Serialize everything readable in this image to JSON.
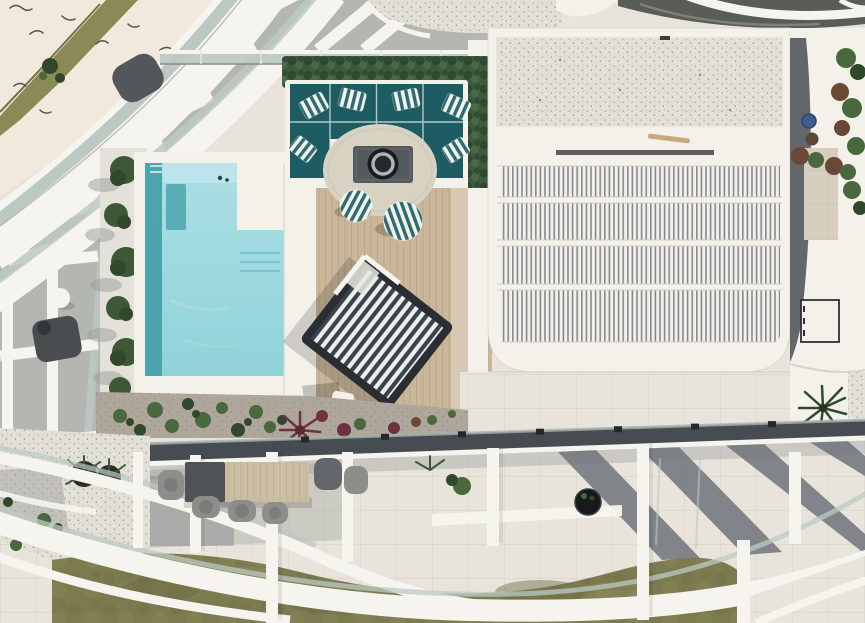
{
  "scene": {
    "title": "Aerial drone view of a modern luxury penthouse rooftop terrace with pool",
    "description": "Top-down photograph: L-shaped turquoise rooftop pool edged by palms, timber deck with teal U-shaped lounge sofa, striped pillows, round rug with fire table, two striped poufs, a navy-striped canopy daybed, a white building wing with rows of louvered roof slats and a gravel roof panel, curved white balcony bands with glass railings sweeping around a lower terrace with an outdoor dining table, olive lawn, tiled patio with long beam shadows, and planters along the right edge.",
    "objects": [
      {
        "name": "pool",
        "details": "L-shaped, light turquoise with darker overflow edge, submerged bench, three steps, small pool robot"
      },
      {
        "name": "lounge-set",
        "details": "dark teal U-sofa with six white/teal striped pillows, round beige rug, grey fire table with black bowl, two striped round poufs"
      },
      {
        "name": "daybed",
        "details": "rotated navy/white striped canopy daybed on timber deck"
      },
      {
        "name": "louvre-roof",
        "details": "four rows of fine vertical slats inside white frame, gravel panel above"
      },
      {
        "name": "dining-set",
        "details": "lower terrace table, dark end + timber top, grey chairs"
      },
      {
        "name": "landscape",
        "details": "hedge planter behind sofa, palm row beside pool, mulch garden bed with green and red plants, olive lawn, gravel corner with potted palms"
      },
      {
        "name": "architecture",
        "details": "sweeping curved white balcony bands with glass balustrades, white pergola beams, dark roof curve top-right, right-side planters, rooftop AC unit"
      }
    ],
    "colors": {
      "base_tile": "#E8E4DB",
      "pavement": "#F1EADC",
      "grass": "#8A8A57",
      "white_band": "#F6F4EE",
      "white_struct": "#F3F1EA",
      "glass": "#BCC9C3",
      "canyon": "#B3B6B1",
      "dark_roof": "#5A5C57",
      "deck": "#C9B69B",
      "deck_light": "#D6C9B3",
      "deck_line": "#A8946F",
      "pool_light": "#ABDFE4",
      "pool_mid": "#8FD3D9",
      "pool_deep": "#46A1AA",
      "pool_shallow": "#BCE6EA",
      "pool_bench": "#51A9B1",
      "hedge": "#3C5A3C",
      "hedge_dark": "#2C452E",
      "hedge_light": "#52714C",
      "sofa": "#1D5C62",
      "pillow_teal": "#2E6B70",
      "rug": "#D8D2C3",
      "fire_table": "#54595D",
      "daybed_navy": "#37434F",
      "daybed_frame": "#2A2E33",
      "mulch": "#93897B",
      "plant_green": "#4A683D",
      "plant_dark": "#31482B",
      "plant_red": "#6E3340",
      "plant_brown": "#6B4836",
      "palm": "#3E5836",
      "balustrade": "#474C52",
      "shadow": "#70747A",
      "lawn": "#7C7B4F",
      "lawn_dark": "#6C6B44",
      "lawn_light": "#8F8E60",
      "gravel_bg": "#E2DFD7",
      "gravel_dot": "#B5B1A8",
      "gravel_dot2": "#8F8B82",
      "louvre_slat": "#85898E",
      "table_dark": "#4F5357",
      "wood": "#CCBEA3",
      "chair": "#8D8E8A",
      "chair_dark": "#63666A",
      "beige": "#D8CEBF",
      "blue_item": "#3E5F8E"
    }
  }
}
